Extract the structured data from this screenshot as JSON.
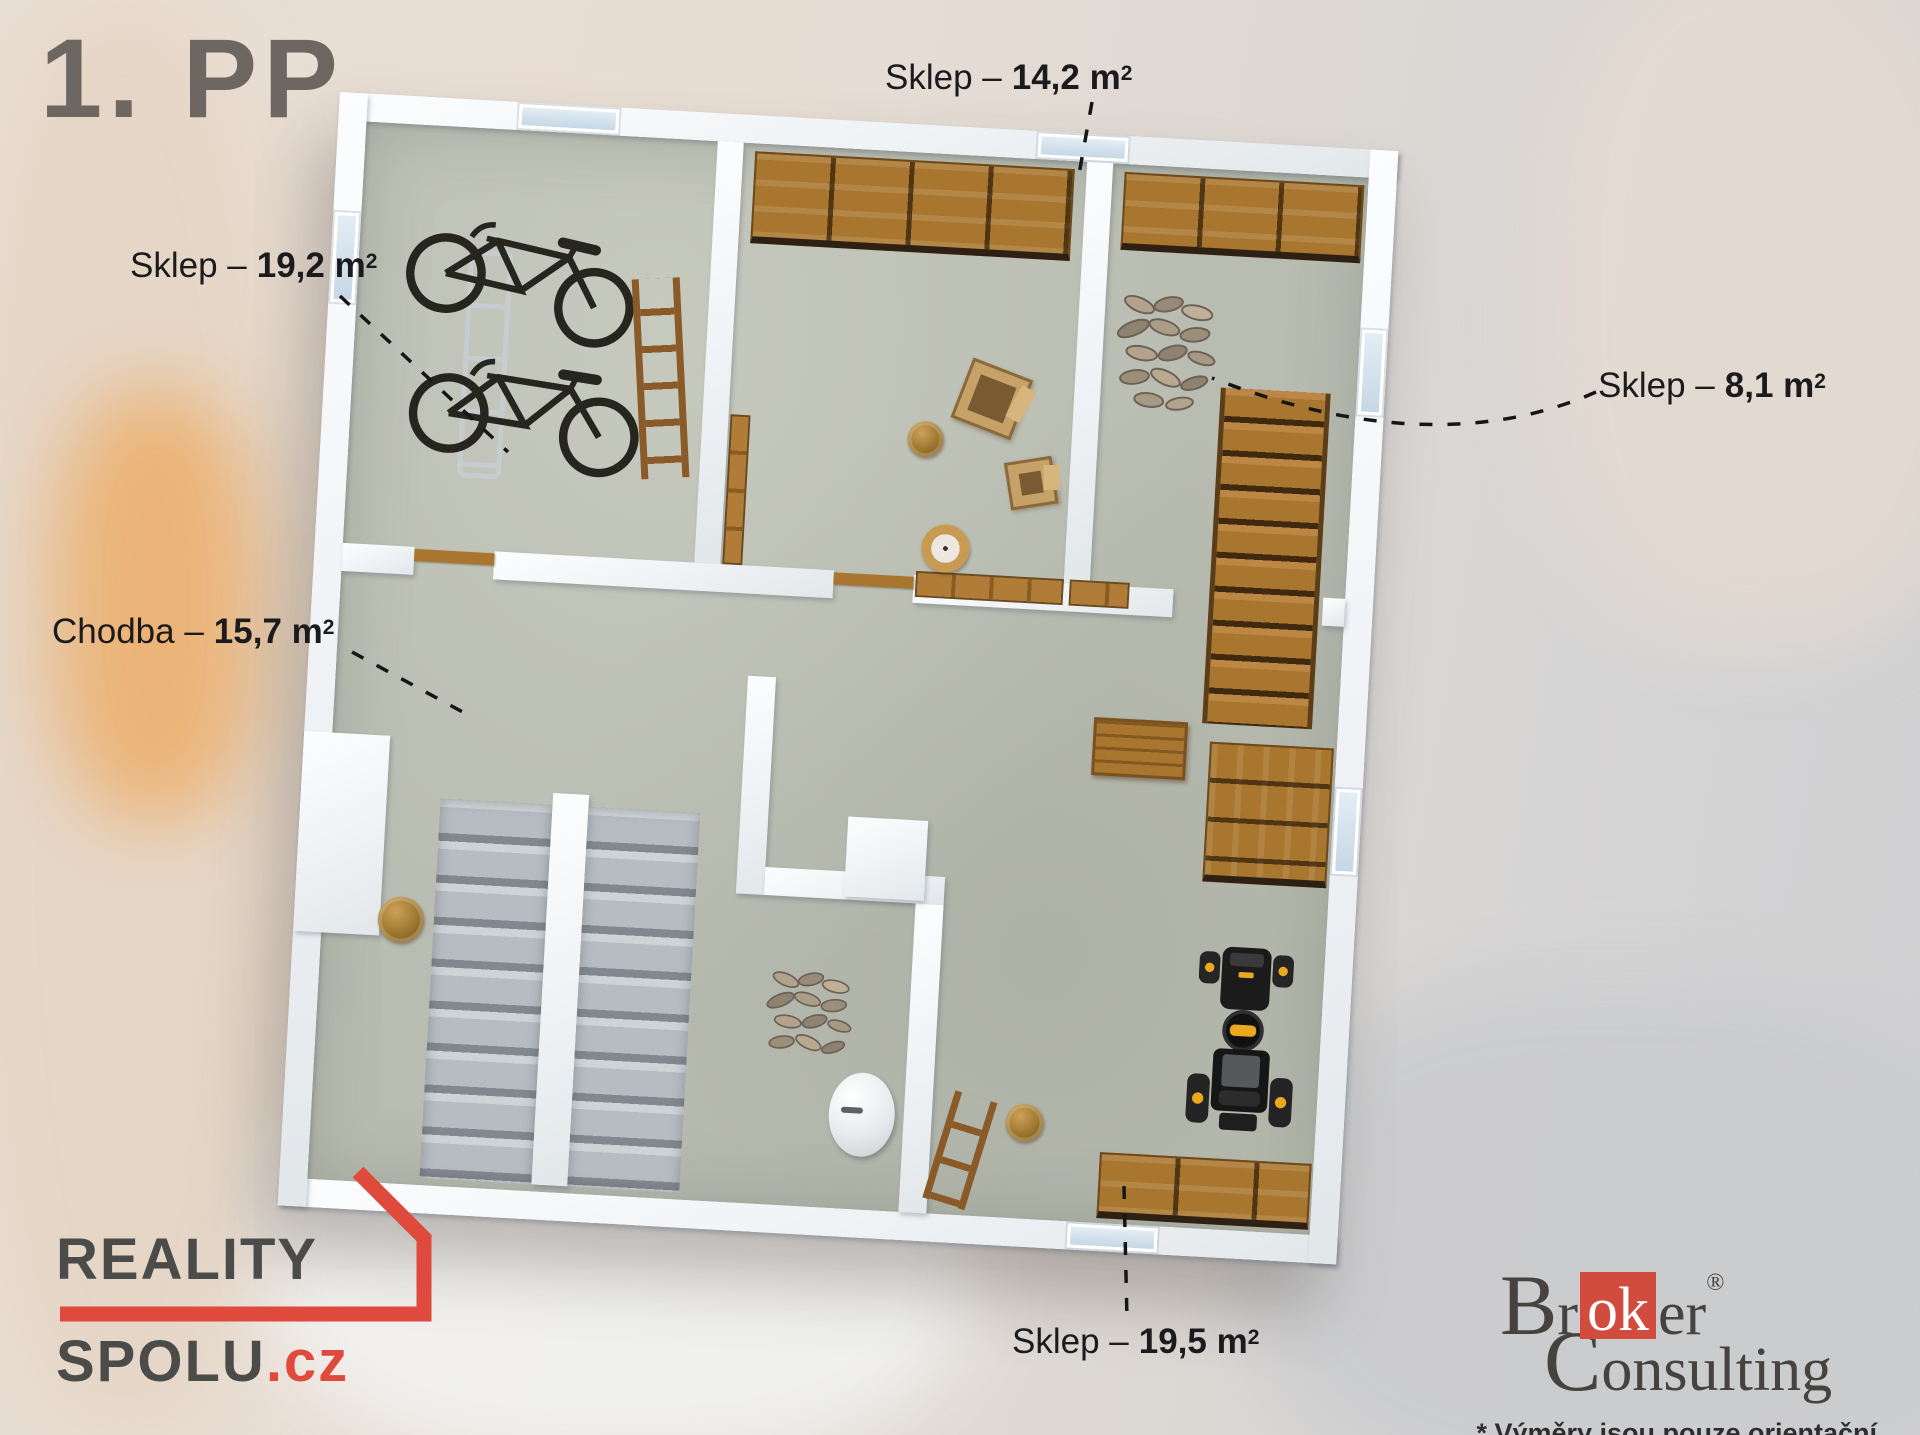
{
  "page": {
    "title": "1. PP"
  },
  "room_labels": {
    "sklep_19_2": {
      "name": "Sklep –",
      "area": "19,2 m",
      "sup": "2"
    },
    "sklep_14_2": {
      "name": "Sklep –",
      "area": "14,2 m",
      "sup": "2"
    },
    "sklep_8_1": {
      "name": "Sklep –",
      "area": "8,1 m",
      "sup": "2"
    },
    "chodba_15_7": {
      "name": "Chodba –",
      "area": "15,7 m",
      "sup": "2"
    },
    "sklep_19_5": {
      "name": "Sklep –",
      "area": "19,5 m",
      "sup": "2"
    }
  },
  "branding": {
    "reality_spolu": {
      "line1": "REALITY",
      "line2": "SPOLU",
      "tld": ".cz"
    },
    "broker_consulting": {
      "cap1": "B",
      "mid1": "r",
      "highlight": "ok",
      "end1": "er",
      "reg": "®",
      "cap2": "C",
      "rest2": "onsulting",
      "disclaimer": "* Výměry jsou pouze orientační."
    }
  },
  "colors": {
    "accent_red": "#df4a3d",
    "title_gray": "#6e6761",
    "label_dark": "#1b1b1d",
    "wall_white": "#f5f7f8",
    "floor_concrete": "#b9bcb1",
    "wood": "#a9762f"
  }
}
